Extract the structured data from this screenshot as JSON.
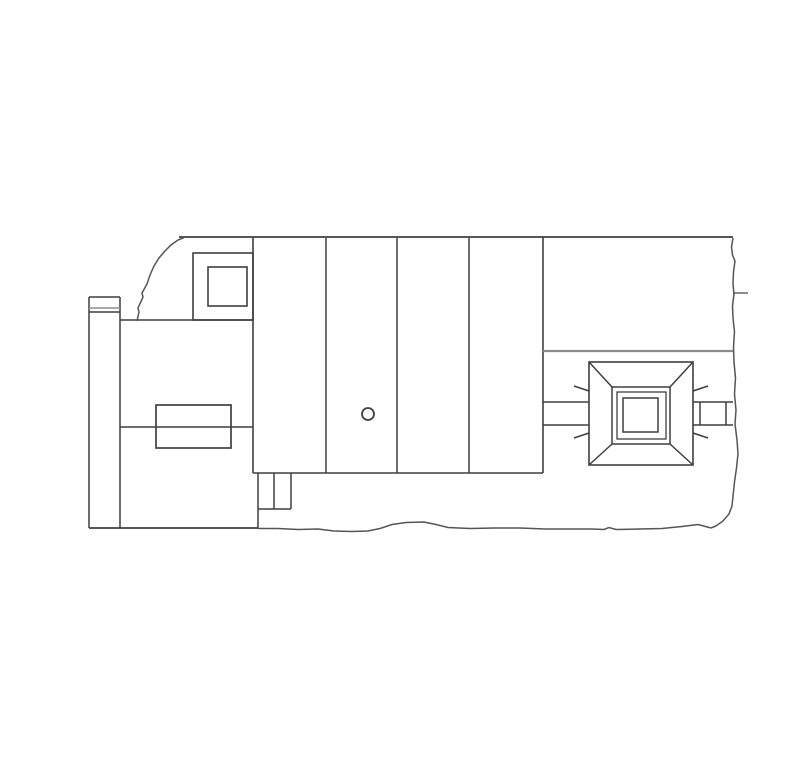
{
  "page": {
    "background": "#ffffff",
    "width": 810,
    "height": 768,
    "content_kind": "cad-line-drawing",
    "visible_text": []
  },
  "colors": {
    "ink": "#3f3f3f",
    "gray": "#8c8c8c",
    "tear": "#555555"
  },
  "drawing": {
    "viewbox": "0 0 810 768",
    "lines": [
      {
        "n": "top-edge",
        "x1": 179,
        "y1": 237,
        "x2": 733,
        "y2": 237,
        "s": "ink",
        "w": 1.7
      },
      {
        "n": "block-divider-1",
        "x1": 253,
        "y1": 237,
        "x2": 253,
        "y2": 473,
        "s": "ink",
        "w": 1.6
      },
      {
        "n": "block-divider-2",
        "x1": 326,
        "y1": 238,
        "x2": 326,
        "y2": 473,
        "s": "ink",
        "w": 1.5
      },
      {
        "n": "block-divider-3",
        "x1": 397,
        "y1": 238,
        "x2": 397,
        "y2": 473,
        "s": "ink",
        "w": 1.5
      },
      {
        "n": "block-divider-4",
        "x1": 469,
        "y1": 238,
        "x2": 469,
        "y2": 473,
        "s": "ink",
        "w": 1.5
      },
      {
        "n": "block-right-edge",
        "x1": 543,
        "y1": 237,
        "x2": 543,
        "y2": 473,
        "s": "ink",
        "w": 1.6
      },
      {
        "n": "block-bottom-edge",
        "x1": 253,
        "y1": 473,
        "x2": 543,
        "y2": 473,
        "s": "ink",
        "w": 1.6
      },
      {
        "n": "left-wing-top",
        "x1": 120,
        "y1": 320,
        "x2": 253,
        "y2": 320,
        "s": "ink",
        "w": 1.5
      },
      {
        "n": "left-wing-mid",
        "x1": 120,
        "y1": 427,
        "x2": 253,
        "y2": 427,
        "s": "ink",
        "w": 1.5
      },
      {
        "n": "strip-top",
        "x1": 89,
        "y1": 297,
        "x2": 120,
        "y2": 297,
        "s": "ink",
        "w": 1.5
      },
      {
        "n": "strip-left",
        "x1": 89,
        "y1": 297,
        "x2": 89,
        "y2": 528,
        "s": "ink",
        "w": 1.5
      },
      {
        "n": "strip-right",
        "x1": 120,
        "y1": 297,
        "x2": 120,
        "y2": 528,
        "s": "ink",
        "w": 1.5
      },
      {
        "n": "strip-band-upper",
        "x1": 89,
        "y1": 308,
        "x2": 120,
        "y2": 308,
        "s": "gray",
        "w": 1.6
      },
      {
        "n": "strip-band-lower",
        "x1": 89,
        "y1": 312,
        "x2": 120,
        "y2": 312,
        "s": "ink",
        "w": 1.6
      },
      {
        "n": "ground-line",
        "x1": 89,
        "y1": 528,
        "x2": 258,
        "y2": 528,
        "s": "ink",
        "w": 1.7
      },
      {
        "n": "notch-left",
        "x1": 258,
        "y1": 473,
        "x2": 258,
        "y2": 529,
        "s": "ink",
        "w": 1.5
      },
      {
        "n": "notch-mid",
        "x1": 274,
        "y1": 473,
        "x2": 274,
        "y2": 509,
        "s": "ink",
        "w": 1.5
      },
      {
        "n": "notch-right",
        "x1": 291,
        "y1": 473,
        "x2": 291,
        "y2": 509,
        "s": "ink",
        "w": 1.5
      },
      {
        "n": "notch-bottom",
        "x1": 258,
        "y1": 509,
        "x2": 291,
        "y2": 509,
        "s": "ink",
        "w": 1.5
      },
      {
        "n": "right-room-divider",
        "x1": 543,
        "y1": 351,
        "x2": 733,
        "y2": 351,
        "s": "gray",
        "w": 2.2
      },
      {
        "n": "duct-left-top",
        "x1": 543,
        "y1": 402,
        "x2": 589,
        "y2": 402,
        "s": "ink",
        "w": 1.5
      },
      {
        "n": "duct-left-bottom",
        "x1": 543,
        "y1": 425,
        "x2": 589,
        "y2": 425,
        "s": "ink",
        "w": 1.5
      },
      {
        "n": "duct-right-top",
        "x1": 693,
        "y1": 402,
        "x2": 733,
        "y2": 402,
        "s": "ink",
        "w": 1.5
      },
      {
        "n": "duct-right-bottom",
        "x1": 693,
        "y1": 425,
        "x2": 733,
        "y2": 425,
        "s": "ink",
        "w": 1.5
      },
      {
        "n": "damper-left",
        "x1": 700,
        "y1": 402,
        "x2": 700,
        "y2": 425,
        "s": "ink",
        "w": 1.5
      },
      {
        "n": "damper-right",
        "x1": 726,
        "y1": 402,
        "x2": 726,
        "y2": 425,
        "s": "ink",
        "w": 1.5
      },
      {
        "n": "edge-tick",
        "x1": 733,
        "y1": 293,
        "x2": 748,
        "y2": 293,
        "s": "gray",
        "w": 2
      },
      {
        "n": "pyramid-diag-tl",
        "x1": 589,
        "y1": 362,
        "x2": 612,
        "y2": 387,
        "s": "ink",
        "w": 1.5
      },
      {
        "n": "pyramid-diag-tr",
        "x1": 693,
        "y1": 362,
        "x2": 670,
        "y2": 387,
        "s": "ink",
        "w": 1.5
      },
      {
        "n": "pyramid-diag-bl",
        "x1": 589,
        "y1": 465,
        "x2": 612,
        "y2": 444,
        "s": "ink",
        "w": 1.5
      },
      {
        "n": "pyramid-diag-br",
        "x1": 693,
        "y1": 465,
        "x2": 670,
        "y2": 444,
        "s": "ink",
        "w": 1.5
      },
      {
        "n": "ray-tick-tl",
        "x1": 574,
        "y1": 386,
        "x2": 589,
        "y2": 391,
        "s": "ink",
        "w": 1.5
      },
      {
        "n": "ray-tick-bl",
        "x1": 574,
        "y1": 438,
        "x2": 589,
        "y2": 433,
        "s": "ink",
        "w": 1.5
      },
      {
        "n": "ray-tick-tr",
        "x1": 693,
        "y1": 391,
        "x2": 708,
        "y2": 386,
        "s": "ink",
        "w": 1.5
      },
      {
        "n": "ray-tick-br",
        "x1": 693,
        "y1": 433,
        "x2": 708,
        "y2": 438,
        "s": "ink",
        "w": 1.5
      }
    ],
    "rects": [
      {
        "n": "corner-room",
        "x": 193,
        "y": 253,
        "w": 60,
        "h": 67,
        "s": "ink",
        "sw": 1.6
      },
      {
        "n": "corner-room-inset",
        "x": 208,
        "y": 267,
        "w": 39,
        "h": 39,
        "s": "ink",
        "sw": 1.6
      },
      {
        "n": "left-equipment-box",
        "x": 156,
        "y": 405,
        "w": 75,
        "h": 43,
        "s": "ink",
        "sw": 1.7
      },
      {
        "n": "skylight-outer",
        "x": 589,
        "y": 362,
        "w": 104,
        "h": 103,
        "s": "ink",
        "sw": 1.6
      },
      {
        "n": "skylight-mid",
        "x": 612,
        "y": 387,
        "w": 58,
        "h": 57,
        "s": "ink",
        "sw": 1.5
      },
      {
        "n": "skylight-frame",
        "x": 617,
        "y": 392,
        "w": 49,
        "h": 47,
        "s": "ink",
        "sw": 1.3
      },
      {
        "n": "skylight-opening",
        "x": 623,
        "y": 398,
        "w": 35,
        "h": 34,
        "s": "ink",
        "sw": 1.5
      }
    ],
    "circles": [
      {
        "n": "drain-symbol",
        "cx": 368,
        "cy": 414,
        "r": 6,
        "s": "ink",
        "sw": 1.8
      }
    ],
    "paths": [
      {
        "n": "break-line-left",
        "d": "M137,321 L139,312 L138,308 L143,297 L142,293 L147,284 L150,275 L154,266 L159,258 L165,251 L171,245 L178,240 L184,237.5",
        "s": "tear",
        "w": 1.5
      },
      {
        "n": "break-line-right",
        "d": "M733,238 L731.5,247 L732.5,255 L735,261 L733.5,272 L733,284 L734,294 L732.5,306 L733,318 L734.5,332 L733.5,347 L734,362 L735.5,378 L734.5,394 L736,410 L735,424 L737,440 L738,454 L736.5,468 L734.5,482 L733,496 L732,506 L729,514 L723,521 L716,526 L711,528",
        "s": "tear",
        "w": 1.5
      },
      {
        "n": "break-line-bottom",
        "d": "M258,528.5 L278,528.5 L298,529.5 L318,529 L334,531 L352,531.5 L368,531 L380,528.5 L392,524.5 L406,522.5 L424,522 L436,524.5 L448,527.5 L470,528.5 L495,528 L520,528 L545,529 L570,529 L592,529 L604,529.5 L609,527.5 L616,529.5 L640,529 L662,528.5 L682,526.5 L698,524.5 L711,528",
        "s": "tear",
        "w": 1.5
      }
    ]
  }
}
